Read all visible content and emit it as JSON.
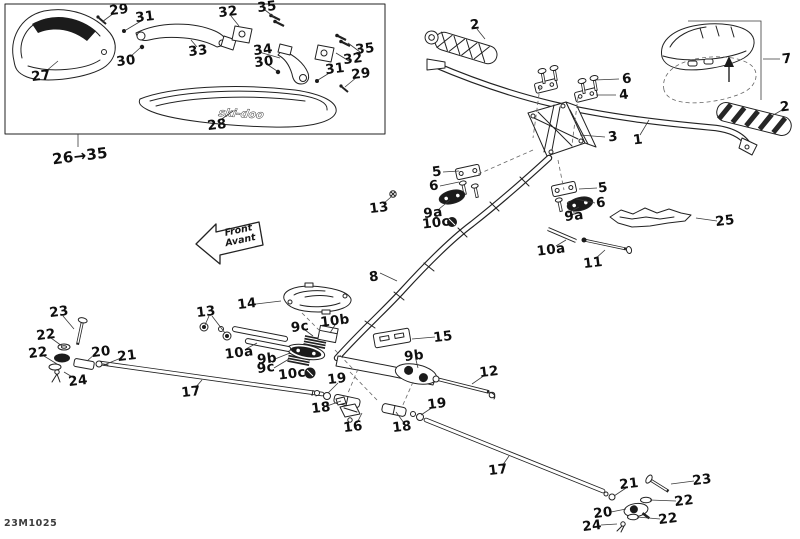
{
  "drawing_code": "23M1025",
  "front_arrow": {
    "top": "Front",
    "bottom": "Avant"
  },
  "inset": {
    "range_label": "26→35",
    "guard_brand": "ski-doo"
  },
  "part_labels": [
    "29",
    "31",
    "32",
    "35",
    "33",
    "30",
    "34",
    "30",
    "35",
    "32",
    "31",
    "29",
    "27",
    "28",
    "2",
    "6",
    "4",
    "3",
    "1",
    "7",
    "2",
    "5",
    "6",
    "5",
    "6",
    "13",
    "9a",
    "10c",
    "9a",
    "25",
    "10a",
    "11",
    "8",
    "14",
    "13",
    "23",
    "22",
    "22",
    "20",
    "21",
    "24",
    "10a",
    "9c",
    "10b",
    "9b",
    "9c",
    "10c",
    "15",
    "9b",
    "19",
    "12",
    "17",
    "18",
    "16",
    "18",
    "19",
    "17",
    "21",
    "23",
    "22",
    "20",
    "22",
    "24"
  ]
}
